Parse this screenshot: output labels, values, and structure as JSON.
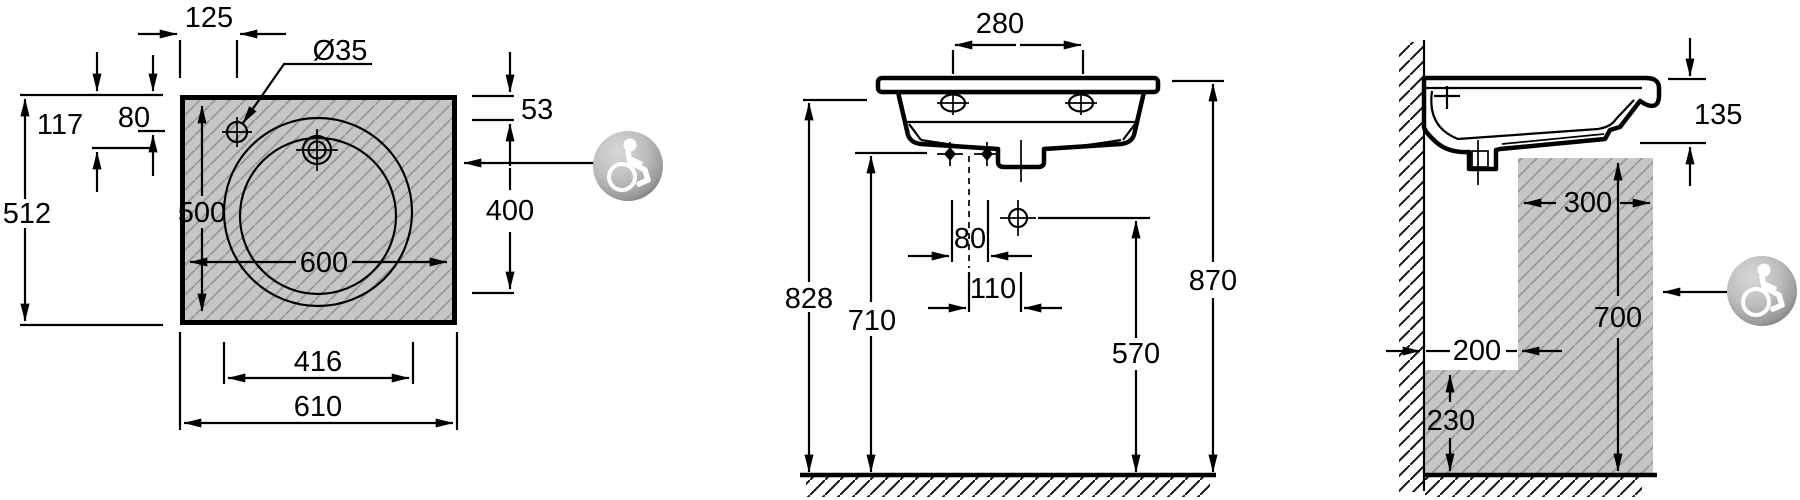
{
  "drawing": {
    "type": "washbasin-installation-technical-drawing",
    "views": {
      "plan_view_name": "plan-view",
      "front_view_name": "front-elevation-view",
      "side_view_name": "side-section-view"
    }
  },
  "plan_view": {
    "dims": {
      "tap_offset": "125",
      "tap_hole_diameter": "Ø35",
      "back_to_bowl_centre": "117",
      "back_to_hole": "80",
      "overall_depth": "512",
      "inner_depth": "500",
      "inner_width": "600",
      "front_fixing_width": "416",
      "overall_width": "610",
      "right_top_offset": "53",
      "right_side_length": "400"
    }
  },
  "front_view": {
    "dims": {
      "tap_centres": "280",
      "floor_to_underside": "828",
      "floor_to_fixings": "710",
      "fixing_spacing": "80",
      "drain_offset": "110",
      "floor_to_rim": "870",
      "supply_height": "570"
    }
  },
  "side_view": {
    "dims": {
      "apron_height": "135",
      "knee_clearance_depth": "300",
      "knee_clearance_height": "700",
      "toe_clearance_depth": "200",
      "toe_clearance_height": "230"
    }
  },
  "icons": {
    "accessibility": "wheelchair-accessibility-icon"
  },
  "colors": {
    "line": "#000000",
    "panel_fill": "#c6c6c6",
    "panel_hatch": "#979797",
    "floor_hatch": "#111111",
    "ball_light": "#d8d8d8",
    "ball_mid": "#bdbdbd",
    "ball_dark": "#6a6a6a",
    "glyph": "#ffffff"
  }
}
